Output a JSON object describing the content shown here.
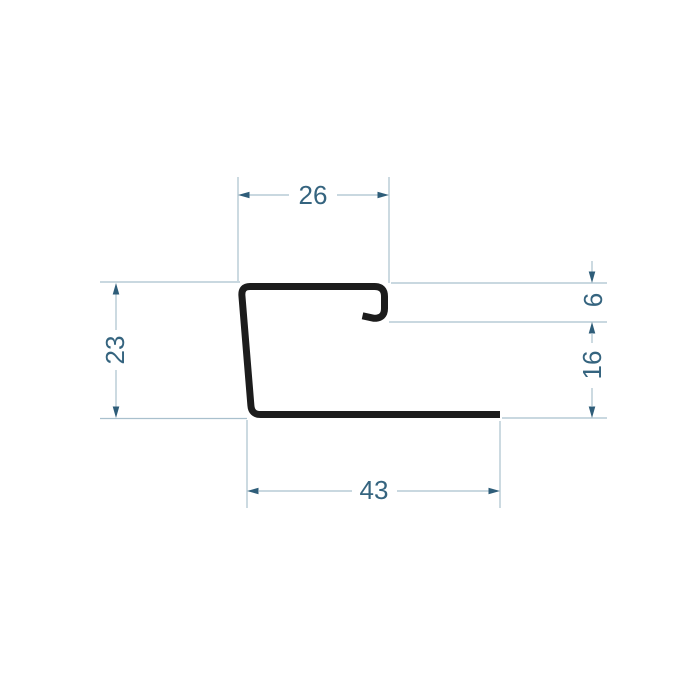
{
  "colors": {
    "background": "#ffffff",
    "profile": "#1c1c1c",
    "dim_line": "#a9c0cd",
    "dim_text": "#35647f",
    "dim_arrow": "#2e5d79"
  },
  "drawing": {
    "kind": "profile-cross-section",
    "dimensions": {
      "top_width": "26",
      "left_height": "23",
      "hook_depth": "6",
      "right_height": "16",
      "bottom_width": "43"
    }
  }
}
